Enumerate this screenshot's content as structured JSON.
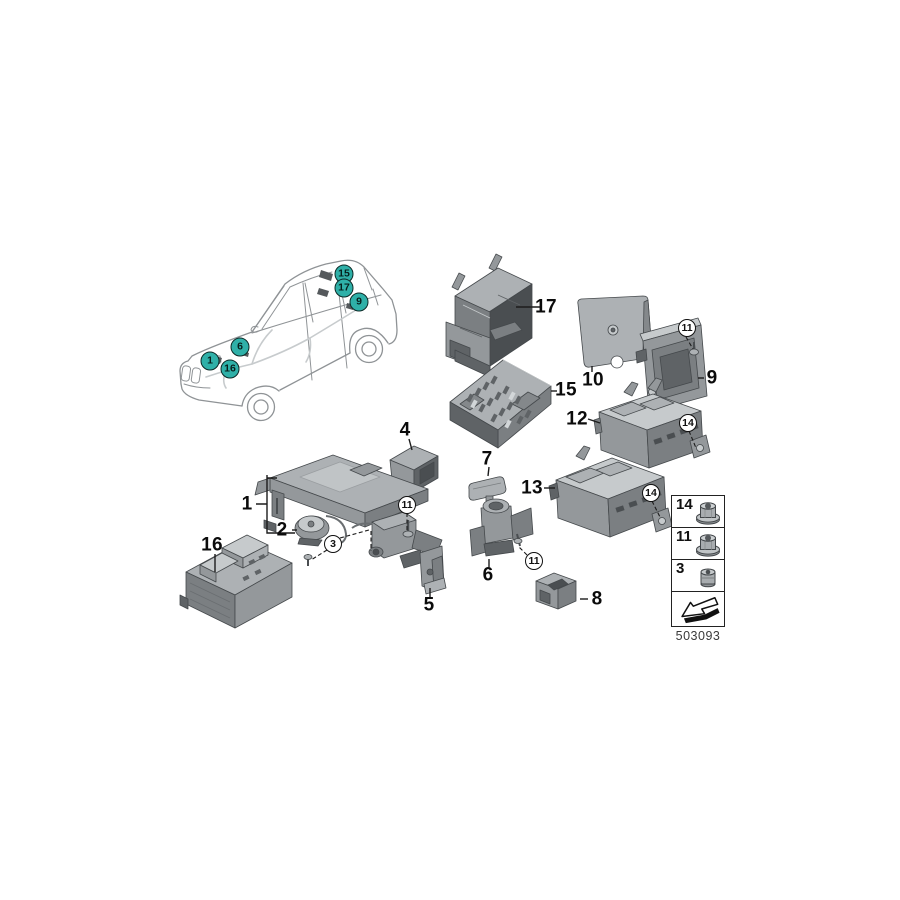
{
  "diagram": {
    "code": "503093",
    "accent_color": "#2fb0a8",
    "car_callouts": [
      {
        "label": "15",
        "x": 344,
        "y": 274
      },
      {
        "label": "17",
        "x": 344,
        "y": 288
      },
      {
        "label": "9",
        "x": 359,
        "y": 302
      },
      {
        "label": "6",
        "x": 240,
        "y": 347
      },
      {
        "label": "1",
        "x": 210,
        "y": 361
      },
      {
        "label": "16",
        "x": 230,
        "y": 369
      }
    ],
    "part_labels": [
      {
        "label": "17",
        "x": 546,
        "y": 307
      },
      {
        "label": "15",
        "x": 566,
        "y": 390
      },
      {
        "label": "10",
        "x": 593,
        "y": 380
      },
      {
        "label": "9",
        "x": 712,
        "y": 378
      },
      {
        "label": "12",
        "x": 577,
        "y": 419
      },
      {
        "label": "13",
        "x": 532,
        "y": 488
      },
      {
        "label": "4",
        "x": 405,
        "y": 430
      },
      {
        "label": "7",
        "x": 487,
        "y": 459
      },
      {
        "label": "1",
        "x": 247,
        "y": 504
      },
      {
        "label": "2",
        "x": 282,
        "y": 530
      },
      {
        "label": "5",
        "x": 429,
        "y": 605
      },
      {
        "label": "6",
        "x": 488,
        "y": 575
      },
      {
        "label": "8",
        "x": 597,
        "y": 599
      },
      {
        "label": "16",
        "x": 212,
        "y": 545
      }
    ],
    "fastener_callouts": [
      {
        "label": "11",
        "x": 687,
        "y": 328
      },
      {
        "label": "14",
        "x": 688,
        "y": 423
      },
      {
        "label": "14",
        "x": 651,
        "y": 493
      },
      {
        "label": "11",
        "x": 407,
        "y": 505
      },
      {
        "label": "3",
        "x": 333,
        "y": 544
      },
      {
        "label": "11",
        "x": 534,
        "y": 561
      }
    ],
    "legend": {
      "rows": [
        {
          "label": "14",
          "icon": "flange-nut-icon"
        },
        {
          "label": "11",
          "icon": "flange-nut-icon"
        },
        {
          "label": "3",
          "icon": "cap-nut-icon"
        },
        {
          "label": "",
          "icon": "direction-arrow-icon"
        }
      ]
    }
  }
}
